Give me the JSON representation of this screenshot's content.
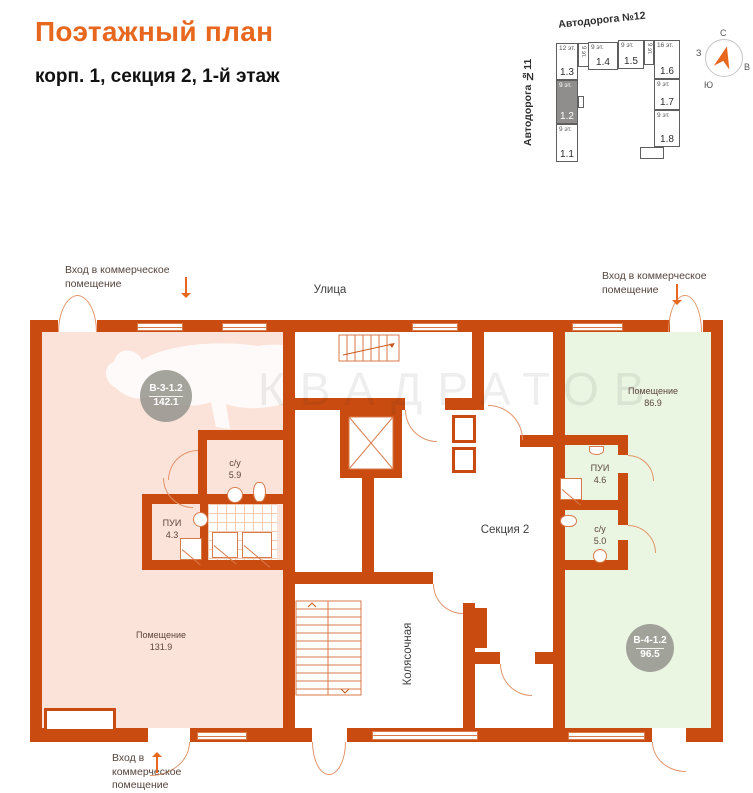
{
  "header": {
    "title": "Поэтажный план",
    "subtitle": "корп. 1, секция 2, 1-й этаж"
  },
  "minimap": {
    "roads": {
      "top": "Автодорога №12",
      "left": "Автодорога №11"
    },
    "buildings": [
      {
        "id": "1.1",
        "floors": "9 эт."
      },
      {
        "id": "1.2",
        "floors": "9 эт."
      },
      {
        "id": "1.3",
        "floors": "12 эт."
      },
      {
        "id": "1.4",
        "floors": "9 эт."
      },
      {
        "id": "1.5",
        "floors": "9 эт."
      },
      {
        "id": "1.6",
        "floors": "16 эт."
      },
      {
        "id": "1.7",
        "floors": "9 эт."
      },
      {
        "id": "1.8",
        "floors": "9 эт."
      },
      {
        "id": "",
        "floors": "9 эт."
      },
      {
        "id": "",
        "floors": "9 эт."
      }
    ],
    "highlighted_building": "1.2",
    "compass": {
      "north": "С",
      "south": "Ю",
      "west": "З",
      "east": "В"
    }
  },
  "plan": {
    "labels": {
      "street": "Улица",
      "entrance_top_left": "Вход в коммерческое помещение",
      "entrance_top_right": "Вход в коммерческое помещение",
      "entrance_bottom": "Вход в коммерческое помещение",
      "section": "Секция 2",
      "stroller_room": "Колясочная"
    },
    "rooms": {
      "left_commercial": {
        "name": "Помещение",
        "area": "131.9"
      },
      "right_commercial": {
        "name": "Помещение",
        "area": "86.9"
      },
      "left_wc": {
        "name": "с/у",
        "area": "5.9"
      },
      "left_pui": {
        "name": "ПУИ",
        "area": "4.3"
      },
      "right_pui": {
        "name": "ПУИ",
        "area": "4.6"
      },
      "right_wc": {
        "name": "с/у",
        "area": "5.0"
      }
    },
    "badges": {
      "left": {
        "code": "В-3-1.2",
        "area": "142.1"
      },
      "right": {
        "code": "В-4-1.2",
        "area": "96.5"
      }
    },
    "watermark": "КВАДРАТОВ"
  },
  "colors": {
    "wall": "#c94b10",
    "accent": "#e8671f",
    "room_pink": "#fbe3da",
    "room_green": "#eaf5e2",
    "badge_gray": "#94948d",
    "highlight_gray": "#8f8e8c"
  }
}
